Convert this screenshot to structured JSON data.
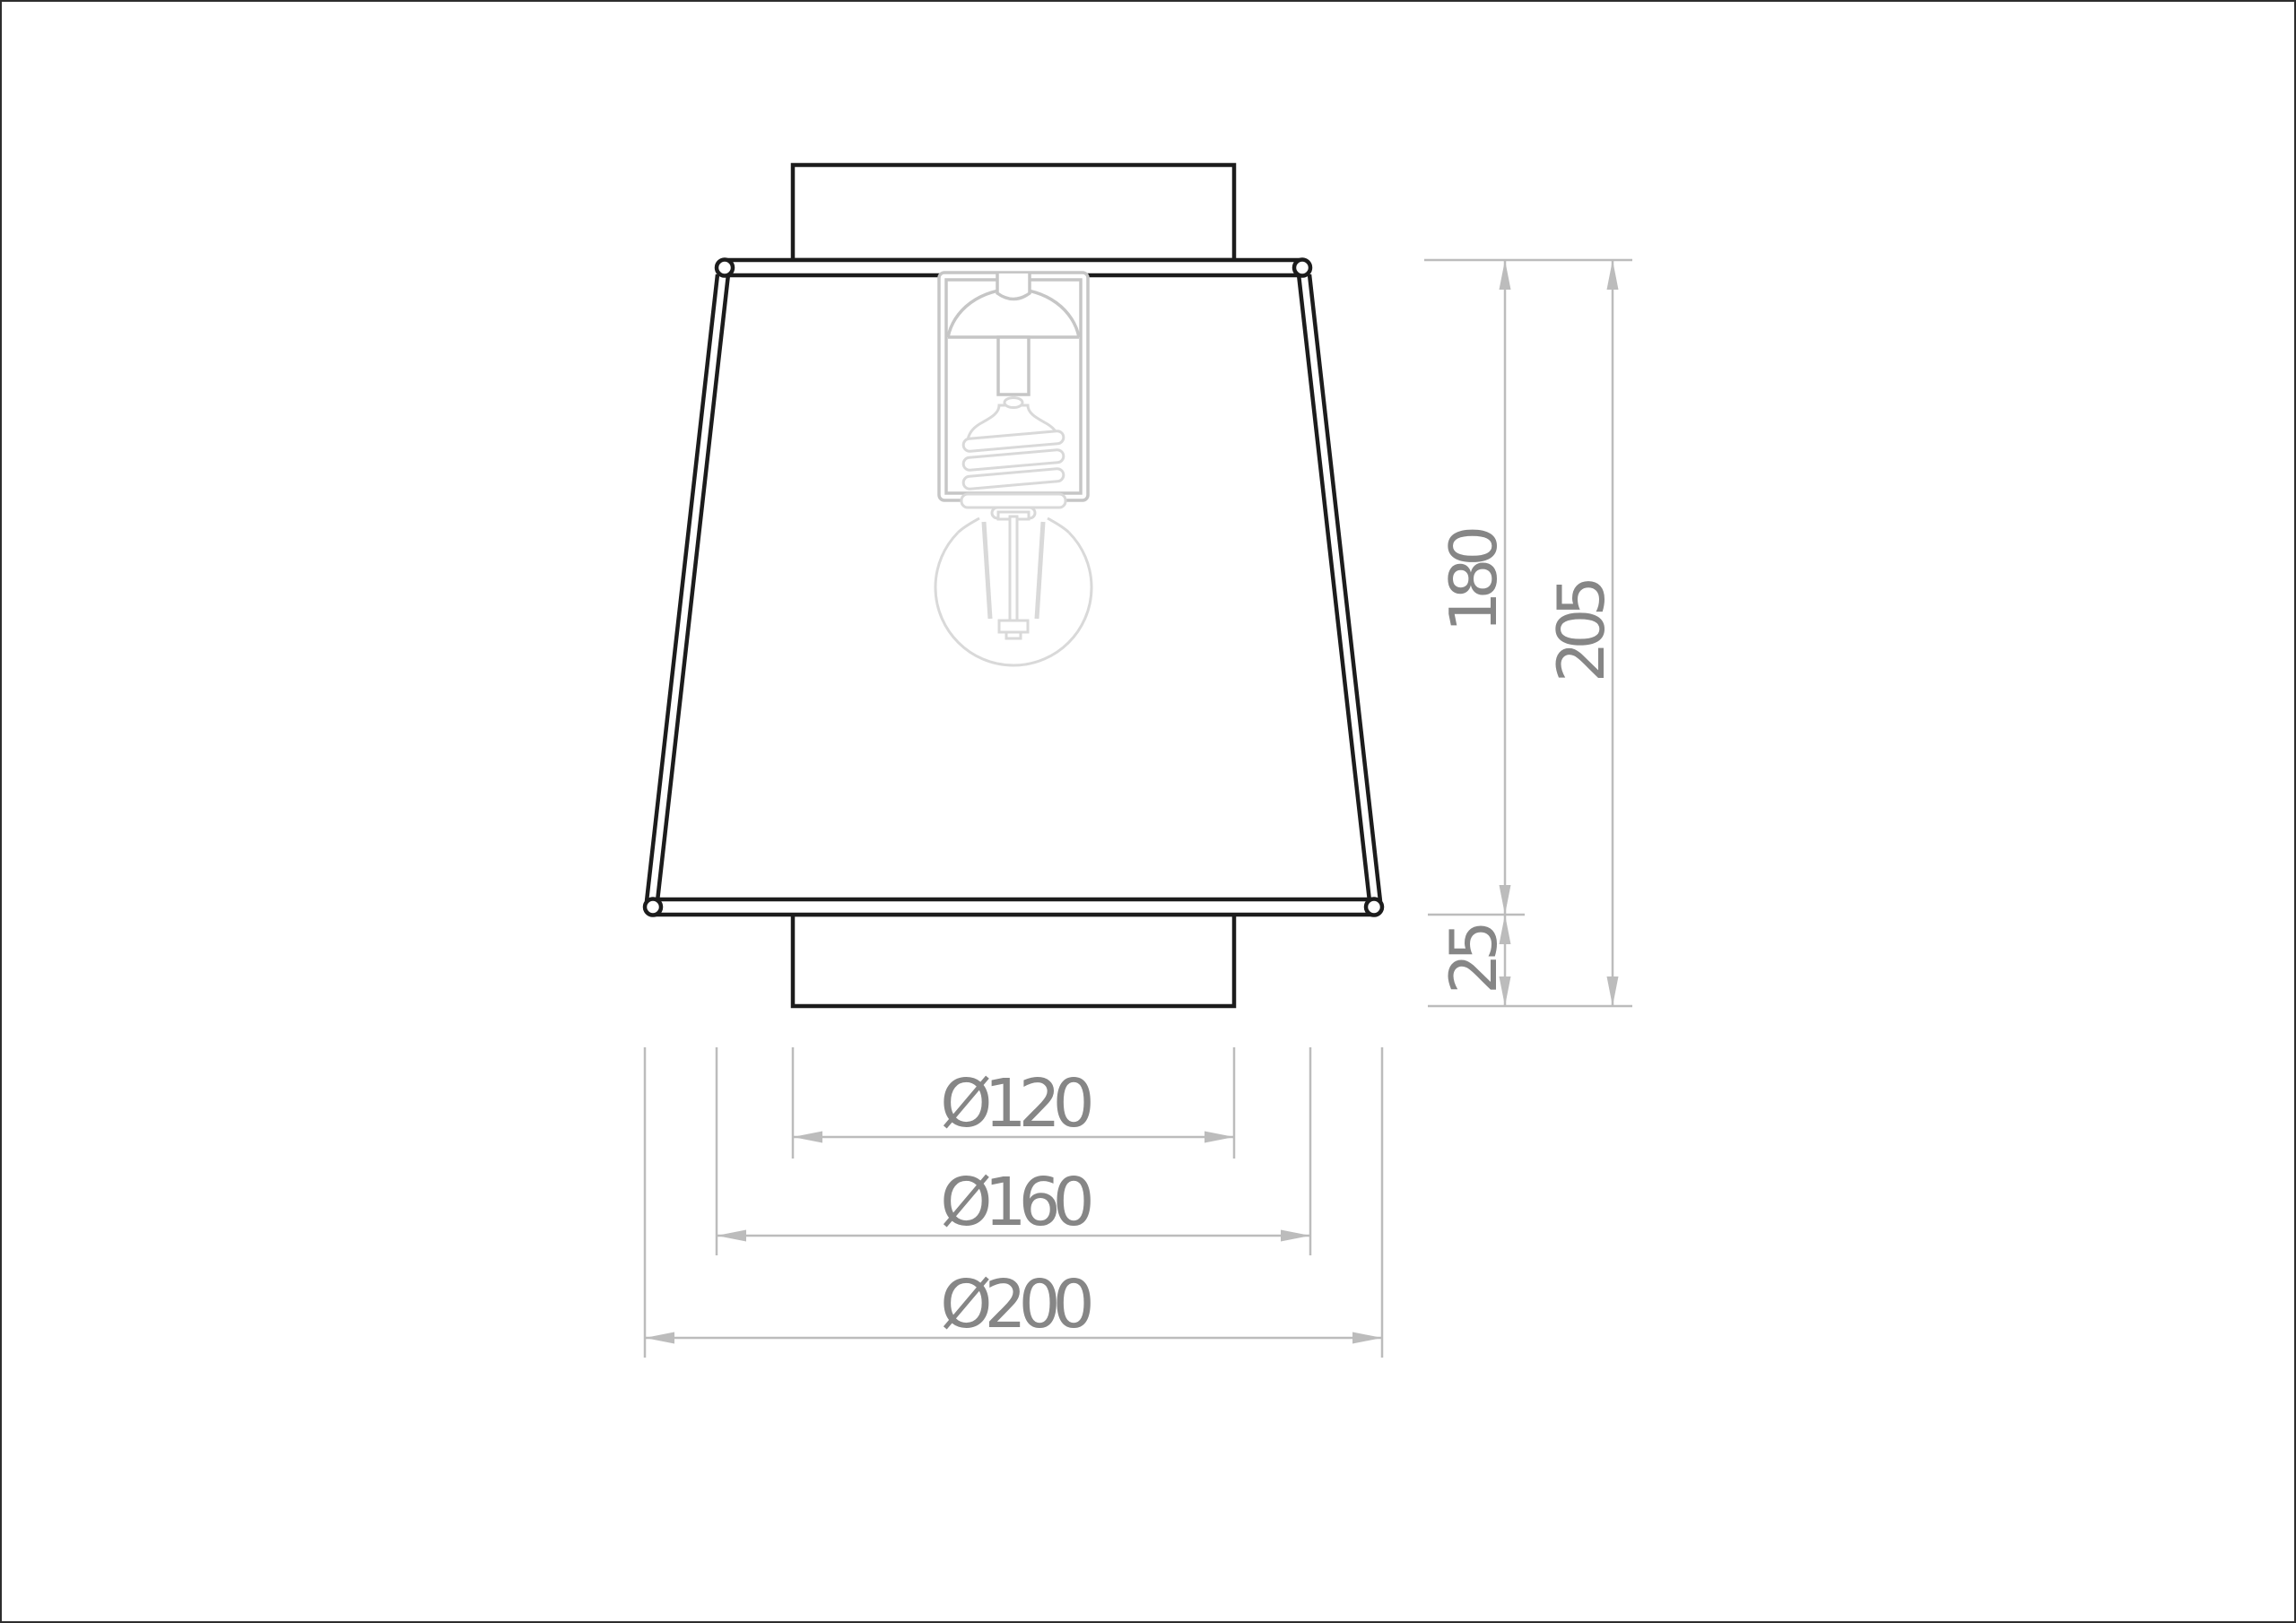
{
  "page": {
    "type": "technical-dimension-drawing",
    "subject": "ceiling lamp with trapezoidal shade, E27 socket and filament bulb",
    "units": "mm",
    "background": "#ffffff",
    "border_color": "#2e2e2e"
  },
  "drawing": {
    "colors": {
      "outline": "#1c1c1c",
      "socket_gray": "#c6c6c6",
      "bulb_gray": "#d9d9d9",
      "dimension_line": "#bcbcbc",
      "dimension_text": "#868686"
    },
    "dimensions": {
      "vertical": [
        {
          "id": "shade-height",
          "label": "180",
          "value": 180
        },
        {
          "id": "total-height",
          "label": "205",
          "value": 205
        },
        {
          "id": "canopy-offset",
          "label": "25",
          "value": 25
        }
      ],
      "horizontal": [
        {
          "id": "canopy-diameter",
          "label": "Ø120",
          "value": 120
        },
        {
          "id": "shade-top-diameter",
          "label": "Ø160",
          "value": 160
        },
        {
          "id": "shade-bottom-diameter",
          "label": "Ø200",
          "value": 200
        }
      ]
    }
  }
}
